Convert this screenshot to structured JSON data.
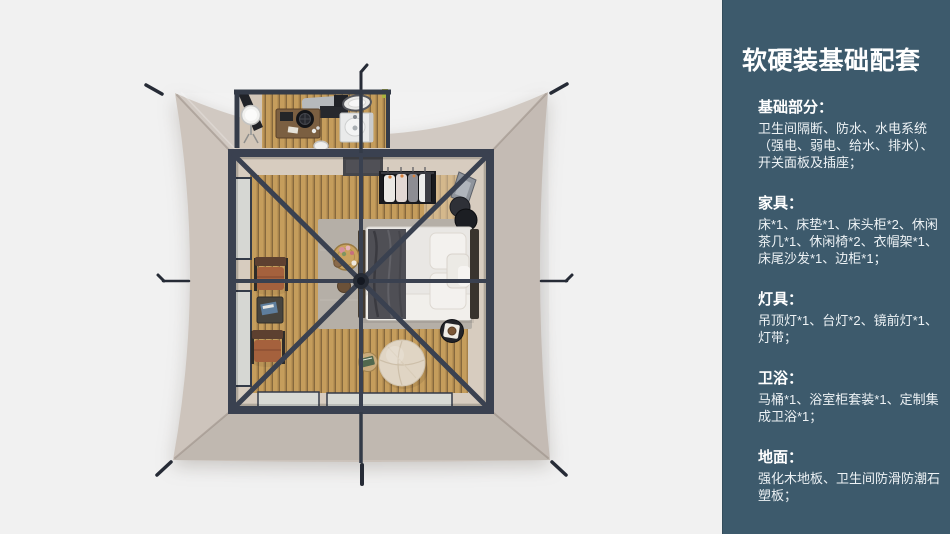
{
  "sidebar": {
    "title": "软硬装基础配套",
    "sections": [
      {
        "heading": "基础部分：",
        "body": "卫生间隔断、防水、水电系统\n（强电、弱电、给水、排水）、\n开关面板及插座；"
      },
      {
        "heading": "家具：",
        "body": "床*1、床垫*1、床头柜*2、休闲\n茶几*1、休闲椅*2、衣帽架*1、\n床尾沙发*1、边柜*1；"
      },
      {
        "heading": "灯具：",
        "body": "吊顶灯*1、台灯*2、镜前灯*1、\n灯带；"
      },
      {
        "heading": "卫浴：",
        "body": "马桶*1、浴室柜套装*1、定制集\n成卫浴*1；"
      },
      {
        "heading": "地面：",
        "body": "强化木地板、卫生间防滑防潮石\n塑板；"
      }
    ]
  },
  "illustration": {
    "type": "tent-floorplan-top-view"
  },
  "colors": {
    "page_bg": "#f1f1f1",
    "sidebar_bg": "#3d5a6c",
    "sidebar_text": "#ffffff",
    "canvas": "#cbc2ba",
    "frame": "#3a4150",
    "wood_light": "#c59d5c",
    "wood_mid": "#a6814a",
    "wood_gap": "#6e5633",
    "floor_beige": "#d7ccbf",
    "rug": "#b5afa7",
    "bed_white": "#e9e7e4",
    "throw_dark": "#4f4f55",
    "leather": "#a5613d",
    "pouf": "#e0d5c4"
  }
}
